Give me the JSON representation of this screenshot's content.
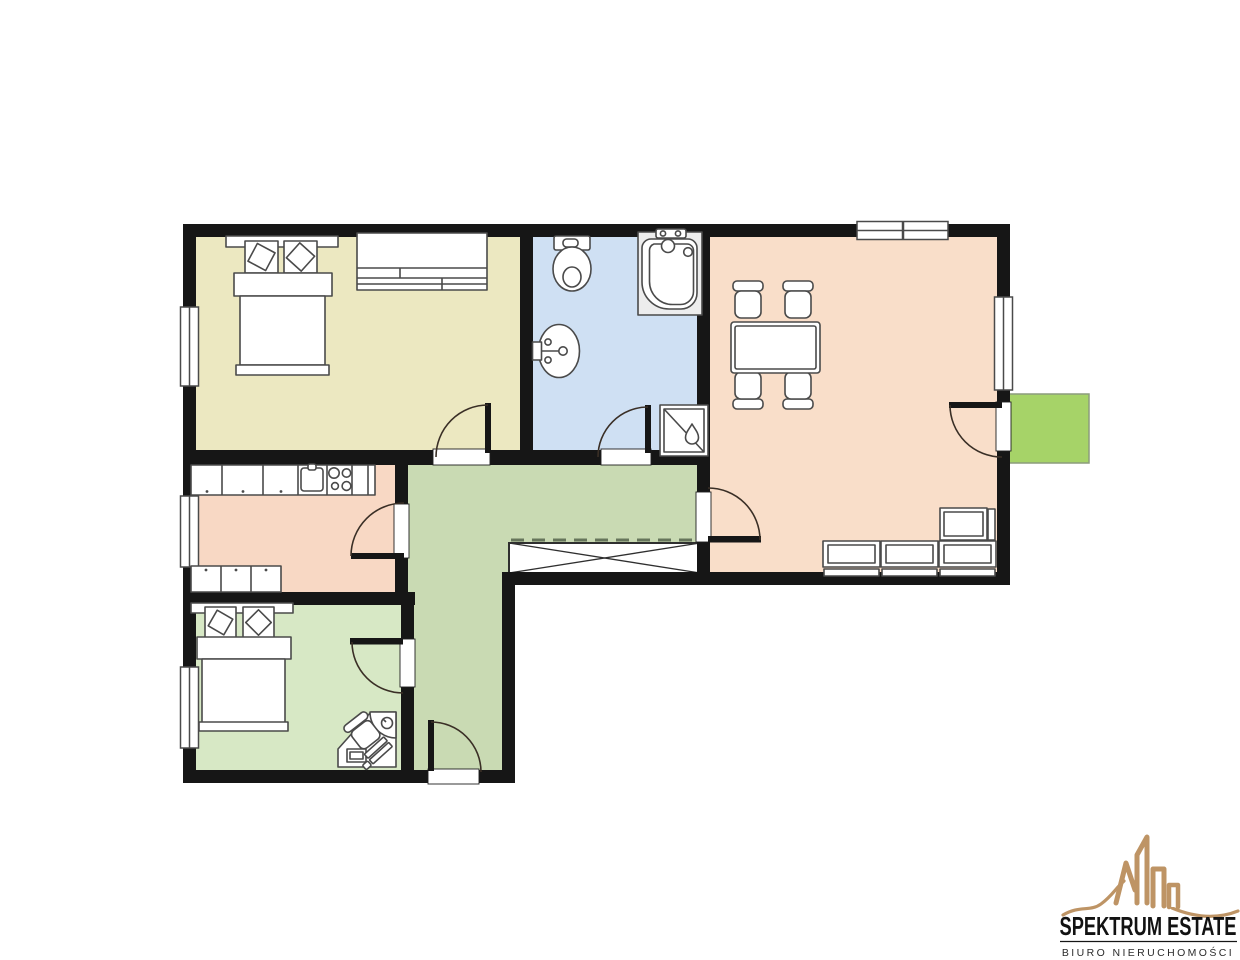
{
  "floorplan": {
    "background": "#FFFFFF",
    "wall_color": "#161616",
    "furniture_outline": "#4A4A4A",
    "door_swing_color": "#3A2F26",
    "threshold_stroke": "#1F1F1F",
    "wardrobe_dash_color": "#66755B",
    "wardrobe_stroke": "#2F2F2F",
    "balcony_border": "#8C9C7C",
    "rooms": [
      {
        "name": "bedroom-1",
        "color": "#ECE8C1"
      },
      {
        "name": "bathroom",
        "color": "#CFE0F3"
      },
      {
        "name": "living-room",
        "color": "#F9DEC9"
      },
      {
        "name": "kitchen",
        "color": "#F8D8C4"
      },
      {
        "name": "hallway",
        "color": "#C9DAB3"
      },
      {
        "name": "bedroom-2",
        "color": "#D7E8C5"
      },
      {
        "name": "balcony",
        "color": "#A6D368"
      }
    ],
    "icons": {
      "bedroom_1": [
        "double-bed-icon",
        "sideboard-icon"
      ],
      "bathroom": [
        "toilet-icon",
        "bathtub-icon",
        "wall-sink-icon",
        "shower-icon"
      ],
      "living_room": [
        "dining-table-icon",
        "dining-chair-icon",
        "corner-sofa-icon"
      ],
      "kitchen": [
        "kitchen-counter-icon",
        "kitchen-sink-icon",
        "stove-icon"
      ],
      "bedroom_2": [
        "double-bed-icon",
        "corner-desk-icon",
        "desk-chair-icon"
      ],
      "hallway": [
        "built-in-wardrobe-icon",
        "entrance-door"
      ]
    }
  },
  "logo": {
    "title": "SPEKTRUM ESTATE",
    "subtitle": "BIURO NIERUCHOMOŚCI",
    "brand_gold": "#BE9465",
    "text_color": "#121212",
    "subtitle_color": "#2B2B2B",
    "divider_color": "#161616"
  }
}
